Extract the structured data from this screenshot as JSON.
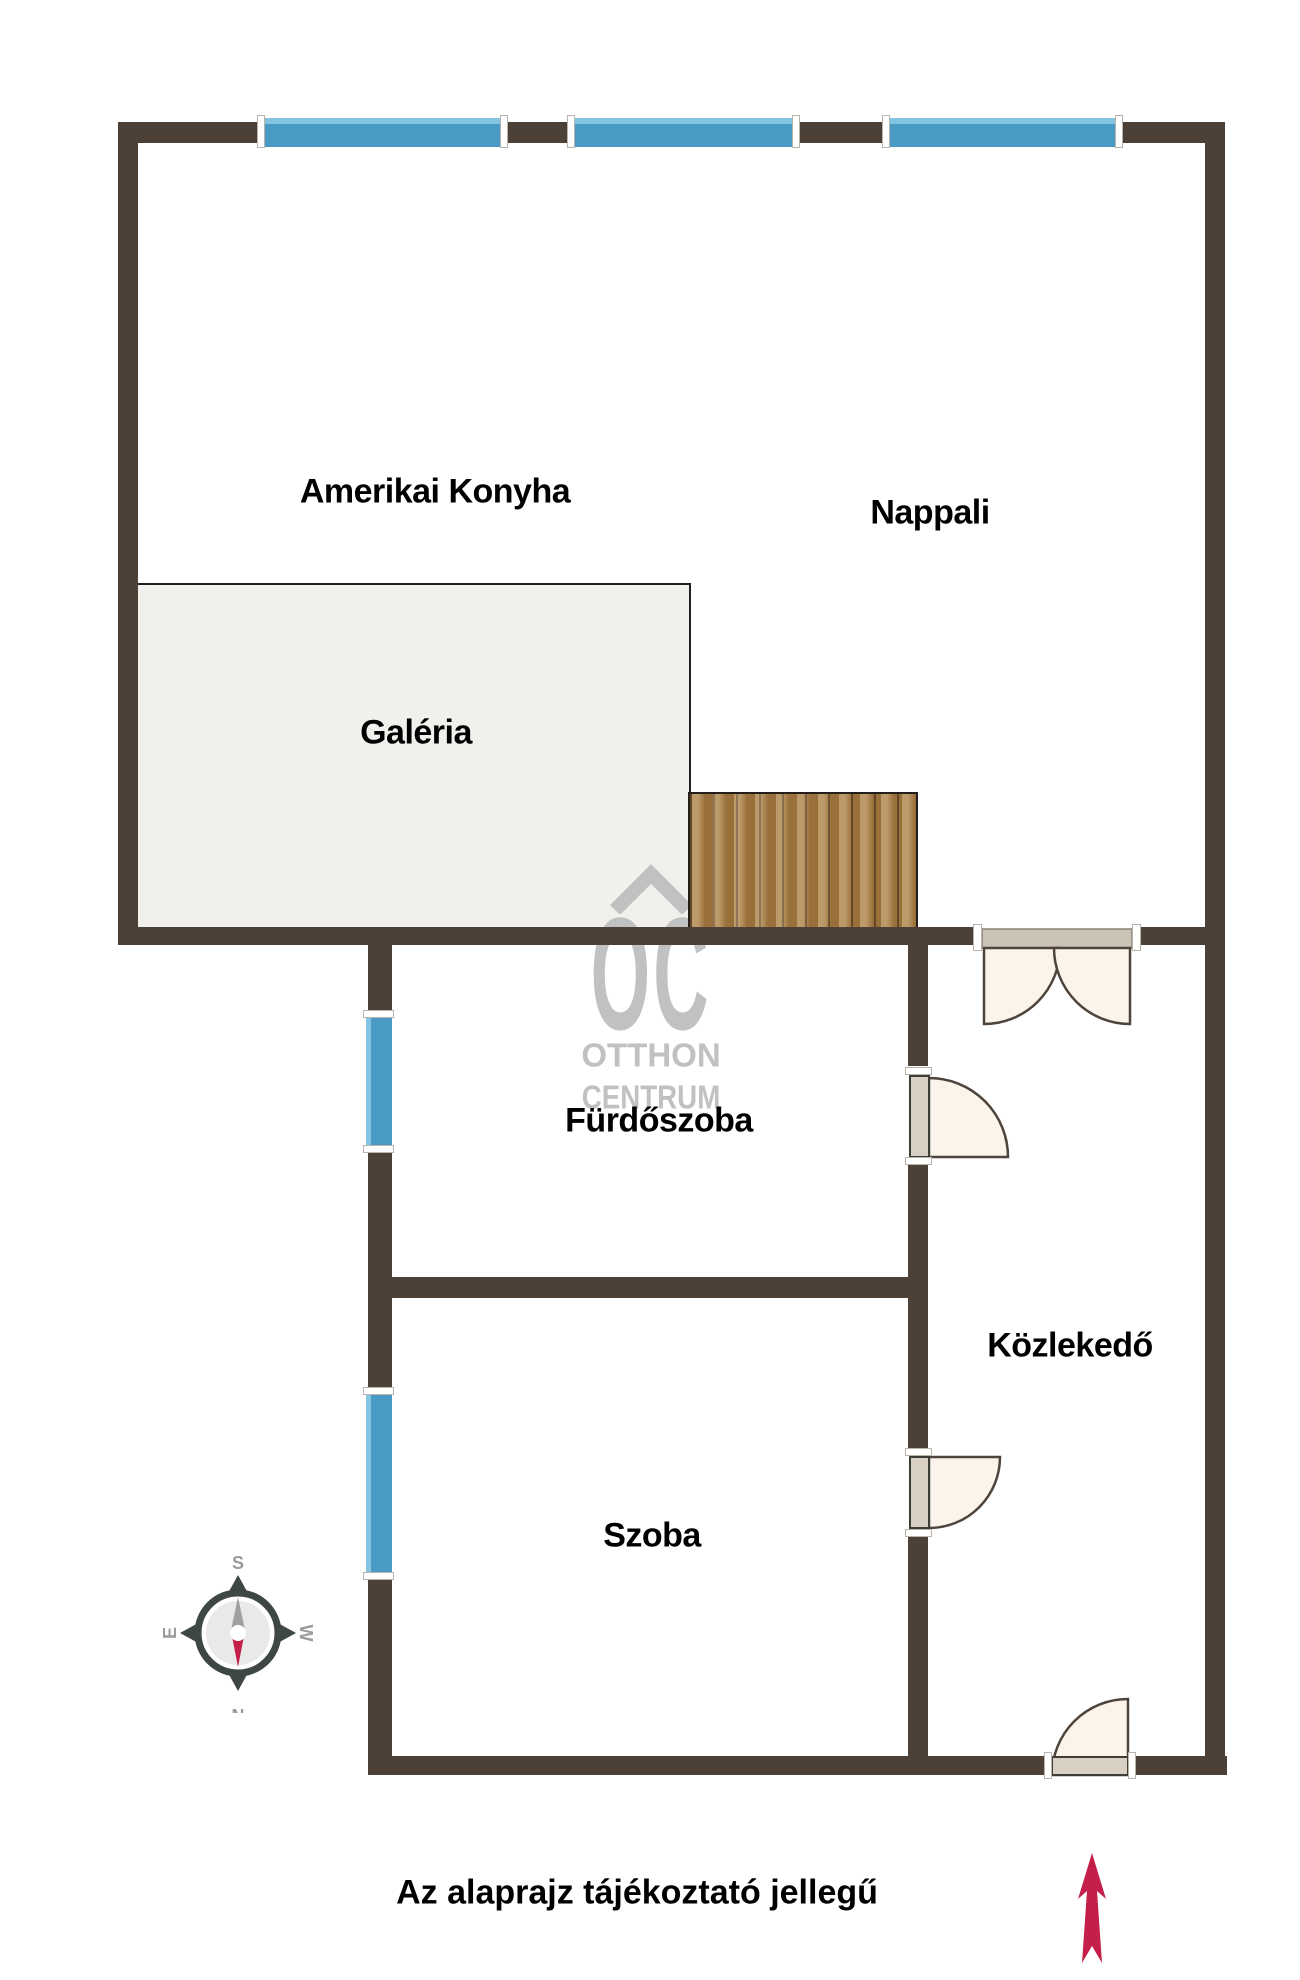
{
  "rooms": {
    "amerikai_konyha": "Amerikai Konyha",
    "nappali": "Nappali",
    "galeria": "Galéria",
    "furdoszoba": "Fürdőszoba",
    "kozlekedo": "Közlekedő",
    "szoba": "Szoba"
  },
  "watermark": {
    "logo": "OC",
    "line1": "OTTHON",
    "line2": "CENTRUM"
  },
  "compass": {
    "top": "S",
    "bottom": "N",
    "left": "E",
    "right": "W"
  },
  "footer": {
    "disclaimer": "Az alaprajz tájékoztató jellegű"
  },
  "colors": {
    "wall": "#4D4036",
    "window_blue": "#4A9AC6",
    "window_blue_light": "#82C4E2",
    "wood": "#AA7D40",
    "wood_dark": "#6E4E27",
    "galeria_bg": "#F2F0EC",
    "galeria_border": "#1F1F1F",
    "door_fill": "#FBF4EB",
    "door_leaf": "#D8D0C3",
    "door_header": "#CBC3B5",
    "door_stroke": "#4E443B",
    "watermark_gray": "#C1C1C1",
    "compass_dark": "#3E4744",
    "compass_gray": "#9B9B9B",
    "accent_red": "#C41F48"
  }
}
